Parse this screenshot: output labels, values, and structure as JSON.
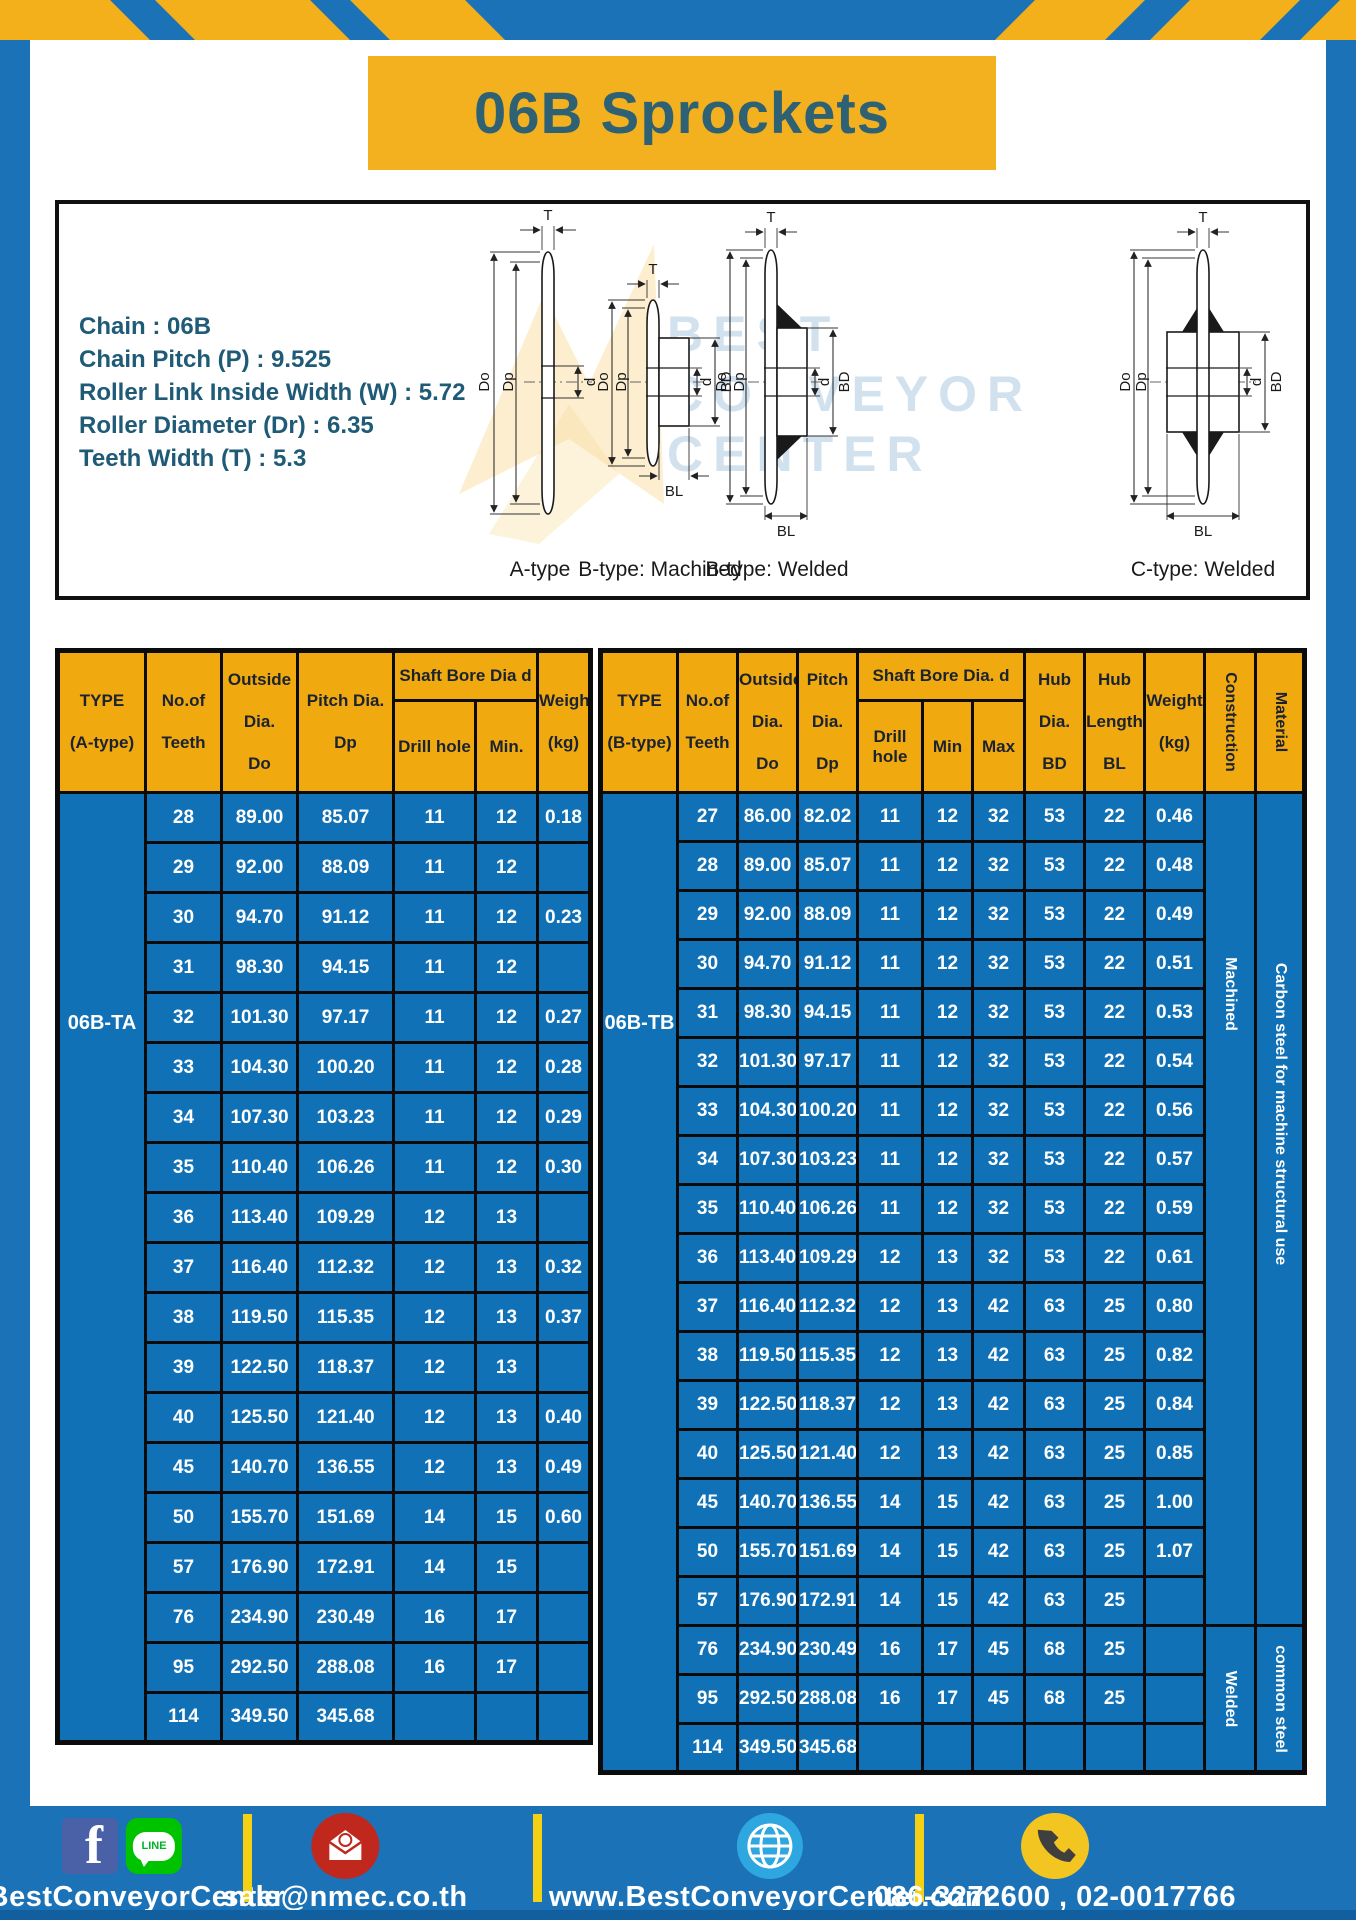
{
  "colors": {
    "frame_blue": "#1b72b7",
    "accent_yellow": "#f3b01b",
    "title_yellow": "#f3b120",
    "title_text": "#2d6173",
    "table_header_yellow": "#f0a90e",
    "table_cell_blue": "#1171b7",
    "footer_divider_yellow": "#f5d113"
  },
  "page": {
    "title": "06B Sprockets"
  },
  "specs": {
    "lines": [
      "Chain : 06B",
      "Chain Pitch (P) : 9.525",
      "Roller Link Inside Width (W) : 5.72",
      "Roller Diameter (Dr) : 6.35",
      "Teeth Width (T) : 5.3"
    ]
  },
  "diagram": {
    "watermark": [
      "BEST",
      "CONVEYOR",
      "CENTER"
    ],
    "labels": {
      "t": "T",
      "do": "Do",
      "dp": "Dp",
      "d": "d",
      "bd": "BD",
      "bl": "BL"
    },
    "figures": [
      {
        "caption": "A-type"
      },
      {
        "caption": "B-type: Machined"
      },
      {
        "caption": "B-type: Welded"
      },
      {
        "caption": "C-type: Welded"
      }
    ]
  },
  "left_table": {
    "headers": {
      "type1": "TYPE",
      "type2": "(A-type)",
      "teeth1": "No.of",
      "teeth2": "Teeth",
      "out1": "Outside",
      "out2": "Dia.",
      "out3": "Do",
      "pitch1": "Pitch Dia.",
      "pitch2": "Dp",
      "shaft_bore": "Shaft Bore Dia d",
      "drill": "Drill hole",
      "min": "Min.",
      "w1": "Weight",
      "w2": "(kg)"
    },
    "span_cells": [
      {
        "side": "pre",
        "at": 0,
        "span": 19,
        "label": "06B-TA",
        "name": "type-cell",
        "vertical": false,
        "top": "218px"
      }
    ],
    "rows": [
      [
        "28",
        "89.00",
        "85.07",
        "11",
        "12",
        "0.18"
      ],
      [
        "29",
        "92.00",
        "88.09",
        "11",
        "12",
        ""
      ],
      [
        "30",
        "94.70",
        "91.12",
        "11",
        "12",
        "0.23"
      ],
      [
        "31",
        "98.30",
        "94.15",
        "11",
        "12",
        ""
      ],
      [
        "32",
        "101.30",
        "97.17",
        "11",
        "12",
        "0.27"
      ],
      [
        "33",
        "104.30",
        "100.20",
        "11",
        "12",
        "0.28"
      ],
      [
        "34",
        "107.30",
        "103.23",
        "11",
        "12",
        "0.29"
      ],
      [
        "35",
        "110.40",
        "106.26",
        "11",
        "12",
        "0.30"
      ],
      [
        "36",
        "113.40",
        "109.29",
        "12",
        "13",
        ""
      ],
      [
        "37",
        "116.40",
        "112.32",
        "12",
        "13",
        "0.32"
      ],
      [
        "38",
        "119.50",
        "115.35",
        "12",
        "13",
        "0.37"
      ],
      [
        "39",
        "122.50",
        "118.37",
        "12",
        "13",
        ""
      ],
      [
        "40",
        "125.50",
        "121.40",
        "12",
        "13",
        "0.40"
      ],
      [
        "45",
        "140.70",
        "136.55",
        "12",
        "13",
        "0.49"
      ],
      [
        "50",
        "155.70",
        "151.69",
        "14",
        "15",
        "0.60"
      ],
      [
        "57",
        "176.90",
        "172.91",
        "14",
        "15",
        ""
      ],
      [
        "76",
        "234.90",
        "230.49",
        "16",
        "17",
        ""
      ],
      [
        "95",
        "292.50",
        "288.08",
        "16",
        "17",
        ""
      ],
      [
        "114",
        "349.50",
        "345.68",
        "",
        "",
        ""
      ]
    ]
  },
  "right_table": {
    "headers": {
      "type1": "TYPE",
      "type2": "(B-type)",
      "teeth1": "No.of",
      "teeth2": "Teeth",
      "out1": "Outside",
      "out2": "Dia.",
      "out3": "Do",
      "p1": "Pitch",
      "p2": "Dia.",
      "p3": "Dp",
      "shaft_bore": "Shaft Bore Dia. d",
      "drill": "Drill hole",
      "min": "Min",
      "max": "Max",
      "hd1": "Hub",
      "hd2": "Dia.",
      "hd3": "BD",
      "hl1": "Hub",
      "hl2": "Length",
      "hl3": "BL",
      "w1": "Weight",
      "w2": "(kg)",
      "construction": "Construction",
      "material": "Material"
    },
    "span_cells": [
      {
        "side": "pre",
        "at": 0,
        "span": 20,
        "label": "06B-TB",
        "name": "type-cell",
        "vertical": false,
        "top": "218px"
      },
      {
        "side": "post",
        "at": 0,
        "span": 17,
        "label": "Machined",
        "name": "construction-cell",
        "vertical": true,
        "top": "200px"
      },
      {
        "side": "post",
        "at": 0,
        "span": 17,
        "label": "Carbon steel for machine structural use",
        "name": "material-cell",
        "vertical": true,
        "top": "320px"
      },
      {
        "side": "post",
        "at": 17,
        "span": 3,
        "label": "Welded",
        "name": "construction-cell",
        "vertical": true
      },
      {
        "side": "post",
        "at": 17,
        "span": 3,
        "label": "common steel",
        "name": "material-cell",
        "vertical": true
      }
    ],
    "rows": [
      [
        "27",
        "86.00",
        "82.02",
        "11",
        "12",
        "32",
        "53",
        "22",
        "0.46"
      ],
      [
        "28",
        "89.00",
        "85.07",
        "11",
        "12",
        "32",
        "53",
        "22",
        "0.48"
      ],
      [
        "29",
        "92.00",
        "88.09",
        "11",
        "12",
        "32",
        "53",
        "22",
        "0.49"
      ],
      [
        "30",
        "94.70",
        "91.12",
        "11",
        "12",
        "32",
        "53",
        "22",
        "0.51"
      ],
      [
        "31",
        "98.30",
        "94.15",
        "11",
        "12",
        "32",
        "53",
        "22",
        "0.53"
      ],
      [
        "32",
        "101.30",
        "97.17",
        "11",
        "12",
        "32",
        "53",
        "22",
        "0.54"
      ],
      [
        "33",
        "104.30",
        "100.20",
        "11",
        "12",
        "32",
        "53",
        "22",
        "0.56"
      ],
      [
        "34",
        "107.30",
        "103.23",
        "11",
        "12",
        "32",
        "53",
        "22",
        "0.57"
      ],
      [
        "35",
        "110.40",
        "106.26",
        "11",
        "12",
        "32",
        "53",
        "22",
        "0.59"
      ],
      [
        "36",
        "113.40",
        "109.29",
        "12",
        "13",
        "32",
        "53",
        "22",
        "0.61"
      ],
      [
        "37",
        "116.40",
        "112.32",
        "12",
        "13",
        "42",
        "63",
        "25",
        "0.80"
      ],
      [
        "38",
        "119.50",
        "115.35",
        "12",
        "13",
        "42",
        "63",
        "25",
        "0.82"
      ],
      [
        "39",
        "122.50",
        "118.37",
        "12",
        "13",
        "42",
        "63",
        "25",
        "0.84"
      ],
      [
        "40",
        "125.50",
        "121.40",
        "12",
        "13",
        "42",
        "63",
        "25",
        "0.85"
      ],
      [
        "45",
        "140.70",
        "136.55",
        "14",
        "15",
        "42",
        "63",
        "25",
        "1.00"
      ],
      [
        "50",
        "155.70",
        "151.69",
        "14",
        "15",
        "42",
        "63",
        "25",
        "1.07"
      ],
      [
        "57",
        "176.90",
        "172.91",
        "14",
        "15",
        "42",
        "63",
        "25",
        ""
      ],
      [
        "76",
        "234.90",
        "230.49",
        "16",
        "17",
        "45",
        "68",
        "25",
        ""
      ],
      [
        "95",
        "292.50",
        "288.08",
        "16",
        "17",
        "45",
        "68",
        "25",
        ""
      ],
      [
        "114",
        "349.50",
        "345.68",
        "",
        "",
        "",
        "",
        "",
        ""
      ]
    ]
  },
  "footer": {
    "facebook_letter": "f",
    "line_label": "LINE",
    "sections": [
      {
        "text": "@BestConveyorCenter"
      },
      {
        "text": "sale@nmec.co.th"
      },
      {
        "text": "www.BestConveyorCenter.com"
      },
      {
        "text": "086-3272600 , 02-0017766"
      }
    ]
  }
}
